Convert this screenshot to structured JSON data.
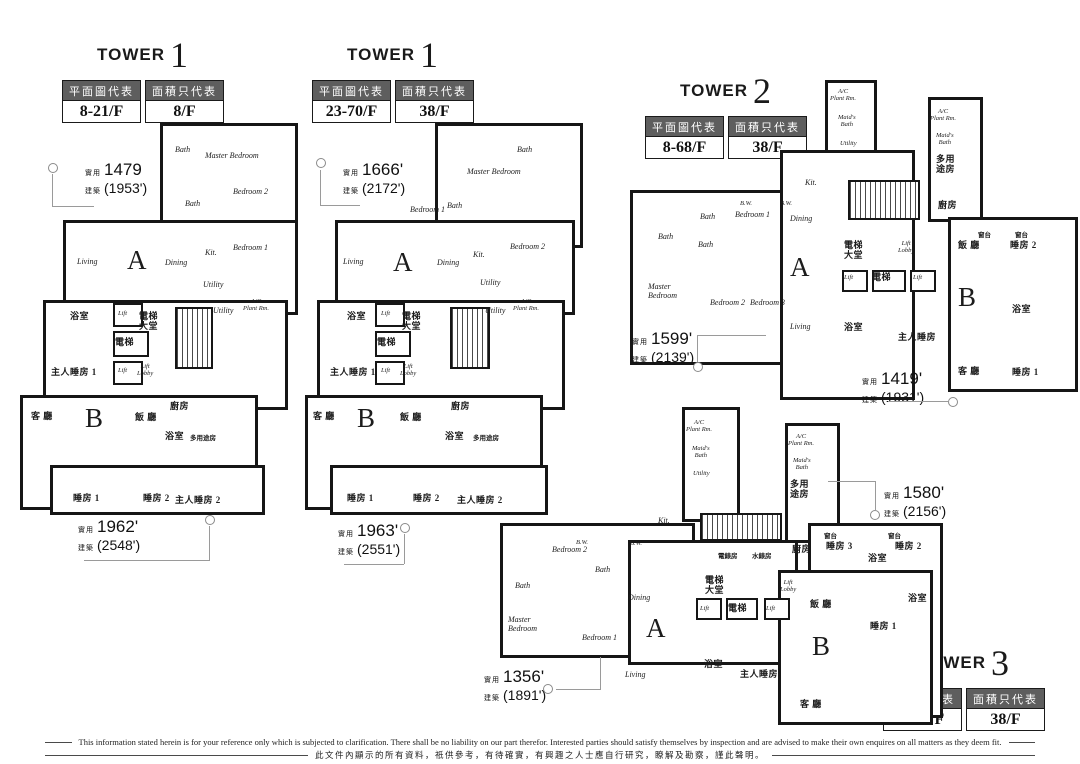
{
  "area_labels": {
    "saleable": "實用",
    "gross": "建築"
  },
  "towers": [
    {
      "name": "tower-1-low",
      "title": "TOWER",
      "number": "1",
      "plan_header": "平面圖代表",
      "area_header": "面積只代表",
      "plan_floors": "8-21/F",
      "area_floor": "8/F"
    },
    {
      "name": "tower-1-high",
      "title": "TOWER",
      "number": "1",
      "plan_header": "平面圖代表",
      "area_header": "面積只代表",
      "plan_floors": "23-70/F",
      "area_floor": "38/F"
    },
    {
      "name": "tower-2",
      "title": "TOWER",
      "number": "2",
      "plan_header": "平面圖代表",
      "area_header": "面積只代表",
      "plan_floors": "8-68/F",
      "area_floor": "38/F"
    },
    {
      "name": "tower-3",
      "title": "TOWER",
      "number": "3",
      "plan_header": "平面圖代表",
      "area_header": "面積只代表",
      "plan_floors": "8-66/F",
      "area_floor": "38/F"
    }
  ],
  "annotations": [
    {
      "name": "area-tower1-low-flat-a",
      "x": 85,
      "y": 160,
      "saleable": "1479",
      "gross": "(1953')",
      "circle": [
        48,
        163
      ],
      "leaders": [
        [
          52,
          174,
          1,
          33
        ],
        [
          52,
          206,
          42,
          1
        ]
      ]
    },
    {
      "name": "area-tower1-low-flat-b",
      "x": 78,
      "y": 517,
      "saleable": "1962'",
      "gross": "(2548')",
      "circle": [
        205,
        515
      ],
      "leaders": [
        [
          84,
          560,
          126,
          1
        ],
        [
          209,
          526,
          1,
          34
        ]
      ]
    },
    {
      "name": "area-tower1-high-flat-a",
      "x": 343,
      "y": 160,
      "saleable": "1666'",
      "gross": "(2172')",
      "circle": [
        316,
        158
      ],
      "leaders": [
        [
          320,
          170,
          1,
          36
        ],
        [
          320,
          205,
          40,
          1
        ]
      ]
    },
    {
      "name": "area-tower1-high-flat-b",
      "x": 338,
      "y": 521,
      "saleable": "1963'",
      "gross": "(2551')",
      "circle": [
        400,
        523
      ],
      "leaders": [
        [
          344,
          564,
          60,
          1
        ],
        [
          404,
          534,
          1,
          30
        ]
      ]
    },
    {
      "name": "area-tower2-flat-a",
      "x": 632,
      "y": 329,
      "saleable": "1599'",
      "gross": "(2139')",
      "circle": [
        693,
        362
      ],
      "leaders": [
        [
          698,
          335,
          68,
          1
        ],
        [
          697,
          335,
          1,
          27
        ]
      ]
    },
    {
      "name": "area-tower2-flat-b",
      "x": 862,
      "y": 369,
      "saleable": "1419'",
      "gross": "(1931')",
      "circle": [
        948,
        397
      ],
      "leaders": [
        [
          888,
          401,
          60,
          1
        ]
      ]
    },
    {
      "name": "area-tower3-flat-b",
      "x": 884,
      "y": 483,
      "saleable": "1580'",
      "gross": "(2156')",
      "circle": [
        870,
        510
      ],
      "leaders": [
        [
          828,
          481,
          47,
          1
        ],
        [
          875,
          481,
          1,
          30
        ]
      ]
    },
    {
      "name": "area-tower3-flat-a",
      "x": 484,
      "y": 667,
      "saleable": "1356'",
      "gross": "(1891')",
      "circle": [
        543,
        684
      ],
      "leaders": [
        [
          556,
          689,
          44,
          1
        ],
        [
          600,
          657,
          1,
          33
        ]
      ]
    }
  ],
  "plans": [
    {
      "name": "tower1-plan-8-21",
      "x": 15,
      "y": 115,
      "w": 285,
      "h": 410,
      "shapes": [
        [
          "o",
          145,
          8,
          138,
          120
        ],
        [
          "o",
          48,
          105,
          235,
          95
        ],
        [
          "o",
          28,
          185,
          245,
          110
        ],
        [
          "o",
          5,
          280,
          238,
          115
        ],
        [
          "o",
          35,
          350,
          215,
          50
        ],
        [
          "b",
          98,
          188,
          30,
          24
        ],
        [
          "b",
          98,
          216,
          36,
          26
        ],
        [
          "b",
          98,
          246,
          30,
          24
        ],
        [
          "st",
          160,
          192,
          38,
          62
        ]
      ],
      "labels": [
        [
          "en",
          160,
          30,
          "Bath"
        ],
        [
          "en",
          190,
          36,
          "Master Bedroom"
        ],
        [
          "en",
          170,
          84,
          "Bath"
        ],
        [
          "en",
          218,
          72,
          "Bedroom 2"
        ],
        [
          "en",
          218,
          128,
          "Bedroom 1"
        ],
        [
          "en",
          62,
          142,
          "Living"
        ],
        [
          "letter",
          112,
          130,
          "A"
        ],
        [
          "en",
          150,
          143,
          "Dining"
        ],
        [
          "en",
          190,
          133,
          "Kit."
        ],
        [
          "en",
          188,
          165,
          "Utility"
        ],
        [
          "en",
          198,
          191,
          "Utility"
        ],
        [
          "ens",
          228,
          183,
          "A/C\nPlant Rm."
        ],
        [
          "zh",
          55,
          196,
          "浴室"
        ],
        [
          "ens",
          103,
          195,
          "Lift"
        ],
        [
          "zh",
          124,
          196,
          "電梯\n大堂"
        ],
        [
          "zh",
          100,
          222,
          "電梯"
        ],
        [
          "ens",
          103,
          252,
          "Lift"
        ],
        [
          "ens",
          122,
          248,
          "Lift\nLobby"
        ],
        [
          "zh",
          36,
          252,
          "主人睡房 1"
        ],
        [
          "zh",
          16,
          296,
          "客 廳"
        ],
        [
          "letter",
          70,
          288,
          "B"
        ],
        [
          "zh",
          120,
          297,
          "飯 廳"
        ],
        [
          "zh",
          155,
          286,
          "廚房"
        ],
        [
          "zh",
          150,
          316,
          "浴室"
        ],
        [
          "zhs",
          175,
          320,
          "多用途房"
        ],
        [
          "zh",
          58,
          378,
          "睡房 1"
        ],
        [
          "zh",
          128,
          378,
          "睡房 2"
        ],
        [
          "zh",
          160,
          380,
          "主人睡房 2"
        ]
      ]
    },
    {
      "name": "tower1-plan-23-70",
      "x": 305,
      "y": 115,
      "w": 280,
      "h": 415,
      "shapes": [
        [
          "o",
          130,
          8,
          148,
          125
        ],
        [
          "o",
          30,
          105,
          240,
          95
        ],
        [
          "o",
          12,
          185,
          248,
          110
        ],
        [
          "o",
          0,
          280,
          238,
          115
        ],
        [
          "o",
          25,
          350,
          218,
          50
        ],
        [
          "b",
          70,
          188,
          30,
          24
        ],
        [
          "b",
          70,
          216,
          36,
          26
        ],
        [
          "b",
          70,
          246,
          30,
          24
        ],
        [
          "st",
          145,
          192,
          40,
          62
        ]
      ],
      "labels": [
        [
          "en",
          212,
          30,
          "Bath"
        ],
        [
          "en",
          162,
          52,
          "Master Bedroom"
        ],
        [
          "en",
          105,
          90,
          "Bedroom 1"
        ],
        [
          "en",
          142,
          86,
          "Bath"
        ],
        [
          "en",
          205,
          127,
          "Bedroom 2"
        ],
        [
          "en",
          38,
          142,
          "Living"
        ],
        [
          "letter",
          88,
          132,
          "A"
        ],
        [
          "en",
          132,
          143,
          "Dining"
        ],
        [
          "en",
          168,
          135,
          "Kit."
        ],
        [
          "en",
          175,
          163,
          "Utility"
        ],
        [
          "en",
          180,
          191,
          "Utility"
        ],
        [
          "ens",
          208,
          183,
          "A/C\nPlant Rm."
        ],
        [
          "zh",
          42,
          196,
          "浴室"
        ],
        [
          "ens",
          76,
          195,
          "Lift"
        ],
        [
          "zh",
          97,
          196,
          "電梯\n大堂"
        ],
        [
          "zh",
          72,
          222,
          "電梯"
        ],
        [
          "ens",
          76,
          252,
          "Lift"
        ],
        [
          "ens",
          95,
          248,
          "Lift\nLobby"
        ],
        [
          "zh",
          25,
          252,
          "主人睡房 1"
        ],
        [
          "zh",
          8,
          296,
          "客 廳"
        ],
        [
          "letter",
          52,
          288,
          "B"
        ],
        [
          "zh",
          95,
          297,
          "飯 廳"
        ],
        [
          "zh",
          146,
          286,
          "廚房"
        ],
        [
          "zh",
          140,
          316,
          "浴室"
        ],
        [
          "zhs",
          168,
          320,
          "多用途房"
        ],
        [
          "zh",
          42,
          378,
          "睡房 1"
        ],
        [
          "zh",
          108,
          378,
          "睡房 2"
        ],
        [
          "zh",
          152,
          380,
          "主人睡房 2"
        ]
      ]
    },
    {
      "name": "tower2-plan",
      "x": 630,
      "y": 72,
      "w": 450,
      "h": 330,
      "shapes": [
        [
          "o",
          195,
          8,
          52,
          105
        ],
        [
          "o",
          298,
          25,
          55,
          125
        ],
        [
          "o",
          0,
          118,
          160,
          175
        ],
        [
          "o",
          150,
          78,
          135,
          250
        ],
        [
          "o",
          318,
          145,
          130,
          175
        ],
        [
          "st",
          218,
          108,
          72,
          40
        ],
        [
          "b",
          212,
          198,
          26,
          22
        ],
        [
          "b",
          242,
          198,
          34,
          22
        ],
        [
          "b",
          280,
          198,
          26,
          22
        ]
      ],
      "labels": [
        [
          "ens",
          200,
          16,
          "A/C\nPlant Rm."
        ],
        [
          "ens",
          208,
          42,
          "Maid's\nBath"
        ],
        [
          "ens",
          210,
          68,
          "Utility"
        ],
        [
          "ens",
          300,
          36,
          "A/C\nPlant Rm."
        ],
        [
          "ens",
          306,
          60,
          "Maid's\nBath"
        ],
        [
          "zh",
          306,
          82,
          "多用\n途房"
        ],
        [
          "en",
          175,
          106,
          "Kit."
        ],
        [
          "zh",
          308,
          128,
          "廚房"
        ],
        [
          "ens",
          110,
          128,
          "B.W."
        ],
        [
          "ens",
          150,
          128,
          "B.W."
        ],
        [
          "en",
          28,
          160,
          "Bath"
        ],
        [
          "en",
          70,
          140,
          "Bath"
        ],
        [
          "en",
          68,
          168,
          "Bath"
        ],
        [
          "en",
          105,
          138,
          "Bedroom 1"
        ],
        [
          "en",
          160,
          142,
          "Dining"
        ],
        [
          "zh",
          214,
          168,
          "電梯\n大堂"
        ],
        [
          "ens",
          268,
          168,
          "Lift\nLobby"
        ],
        [
          "ens",
          214,
          202,
          "Lift"
        ],
        [
          "zh",
          242,
          200,
          "電梯"
        ],
        [
          "ens",
          283,
          202,
          "Lift"
        ],
        [
          "letter",
          160,
          180,
          "A"
        ],
        [
          "en",
          18,
          210,
          "Master\nBedroom"
        ],
        [
          "en",
          80,
          226,
          "Bedroom 2"
        ],
        [
          "en",
          120,
          226,
          "Bedroom 3"
        ],
        [
          "en",
          160,
          250,
          "Living"
        ],
        [
          "zh",
          214,
          250,
          "浴室"
        ],
        [
          "zh",
          268,
          260,
          "主人睡房"
        ],
        [
          "zhs",
          348,
          160,
          "窗台"
        ],
        [
          "zhs",
          385,
          160,
          "窗台"
        ],
        [
          "zh",
          328,
          168,
          "飯 廳"
        ],
        [
          "zh",
          380,
          168,
          "睡房 2"
        ],
        [
          "letter",
          328,
          210,
          "B"
        ],
        [
          "zh",
          382,
          232,
          "浴室"
        ],
        [
          "zh",
          328,
          294,
          "客 廳"
        ],
        [
          "zh",
          382,
          295,
          "睡房 1"
        ]
      ]
    },
    {
      "name": "tower3-plan",
      "x": 480,
      "y": 395,
      "w": 600,
      "h": 340,
      "shapes": [
        [
          "o",
          202,
          12,
          58,
          115
        ],
        [
          "o",
          305,
          28,
          55,
          120
        ],
        [
          "o",
          20,
          128,
          195,
          135
        ],
        [
          "o",
          148,
          145,
          170,
          125
        ],
        [
          "o",
          328,
          128,
          135,
          195
        ],
        [
          "o",
          298,
          175,
          155,
          155
        ],
        [
          "st",
          220,
          118,
          82,
          28
        ],
        [
          "b",
          216,
          203,
          26,
          22
        ],
        [
          "b",
          246,
          203,
          32,
          22
        ],
        [
          "b",
          284,
          203,
          26,
          22
        ]
      ],
      "labels": [
        [
          "ens",
          206,
          24,
          "A/C\nPlant Rm."
        ],
        [
          "ens",
          212,
          50,
          "Maid's\nBath"
        ],
        [
          "ens",
          213,
          75,
          "Utility"
        ],
        [
          "en",
          178,
          121,
          "Kit."
        ],
        [
          "zhs",
          238,
          158,
          "電錶房"
        ],
        [
          "zhs",
          272,
          158,
          "水錶房"
        ],
        [
          "zh",
          225,
          180,
          "電梯\n大堂"
        ],
        [
          "ens",
          300,
          184,
          "Lift\nLobby"
        ],
        [
          "ens",
          220,
          210,
          "Lift"
        ],
        [
          "zh",
          248,
          208,
          "電梯"
        ],
        [
          "ens",
          286,
          210,
          "Lift"
        ],
        [
          "ens",
          96,
          144,
          "B.W."
        ],
        [
          "ens",
          150,
          145,
          "B.W."
        ],
        [
          "en",
          72,
          150,
          "Bedroom 2"
        ],
        [
          "en",
          115,
          170,
          "Bath"
        ],
        [
          "en",
          35,
          186,
          "Bath"
        ],
        [
          "en",
          28,
          220,
          "Master\nBedroom"
        ],
        [
          "en",
          102,
          238,
          "Bedroom 1"
        ],
        [
          "en",
          148,
          198,
          "Dining"
        ],
        [
          "letter",
          166,
          218,
          "A"
        ],
        [
          "en",
          145,
          275,
          "Living"
        ],
        [
          "zh",
          224,
          264,
          "浴室"
        ],
        [
          "zh",
          260,
          274,
          "主人睡房"
        ],
        [
          "ens",
          308,
          38,
          "A/C\nPlant Rm."
        ],
        [
          "ens",
          313,
          62,
          "Maid's\nBath"
        ],
        [
          "zh",
          310,
          84,
          "多用\n途房"
        ],
        [
          "zh",
          312,
          149,
          "廚房"
        ],
        [
          "zh",
          346,
          146,
          "睡房 3"
        ],
        [
          "zh",
          388,
          158,
          "浴室"
        ],
        [
          "zh",
          415,
          146,
          "睡房 2"
        ],
        [
          "zhs",
          344,
          138,
          "窗台"
        ],
        [
          "zhs",
          408,
          138,
          "窗台"
        ],
        [
          "zh",
          330,
          204,
          "飯 廳"
        ],
        [
          "letter",
          332,
          236,
          "B"
        ],
        [
          "zh",
          390,
          226,
          "睡房 1"
        ],
        [
          "zh",
          428,
          198,
          "浴室"
        ],
        [
          "zh",
          320,
          304,
          "客 廳"
        ]
      ]
    }
  ],
  "footer": {
    "line_en": "This information stated herein is for your reference only which is subjected to clarification.  There shall be no liability on our part therefor.  Interested parties should satisfy themselves by inspection and are advised to make their own enquires on all matters as they deem fit.",
    "line_zh": "此文件內顯示的所有資料，祇供參考，有待確實，有興趣之人士應自行研究，瞭解及勘察，謹此聲明。"
  }
}
